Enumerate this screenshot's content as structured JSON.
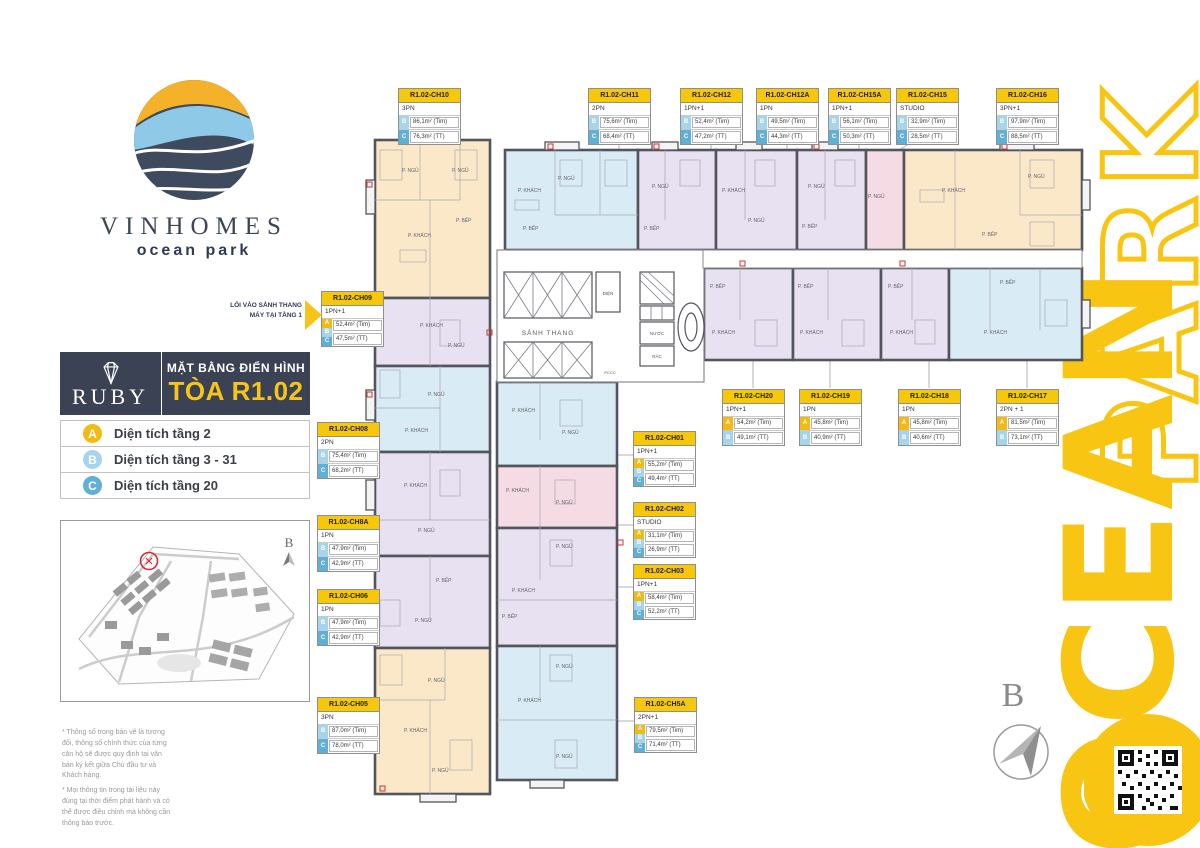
{
  "branding": {
    "logo_title": "VINHOMES",
    "logo_subtitle": "ocean park",
    "ruby_label": "RUBY",
    "plan_title_line1": "MẶT BẰNG ĐIỂN HÌNH",
    "plan_title_line2": "TÒA R1.02",
    "vertical_word1": "OCEAN",
    "vertical_word2": "PARK",
    "accent_yellow": "#F7C51A",
    "navy": "#3A4254"
  },
  "legend": {
    "items": [
      {
        "letter": "A",
        "label": "Diện tích tầng 2"
      },
      {
        "letter": "B",
        "label": "Diện tích tầng 3 - 31"
      },
      {
        "letter": "C",
        "label": "Diện tích tầng 20"
      }
    ]
  },
  "entry_note": {
    "line1": "LỐI VÀO SẢNH THANG",
    "line2": "MÁY TẠI TẦNG 1"
  },
  "compass": {
    "label": "B"
  },
  "core": {
    "lobby": "SẢNH THANG",
    "electric": "ĐIỆN",
    "water": "NƯỚC",
    "trash": "RÁC",
    "fire": "PCCC"
  },
  "rooms": {
    "bedroom": "P. NGỦ",
    "living": "P. KHÁCH",
    "kitchen": "P. BẾP",
    "dining": "P. ĂN",
    "loggia": "LÔ GIA"
  },
  "footnotes": [
    "* Thông số trong bản vẽ là tương đối, thông số chính thức của từng căn hộ sẽ được quy định tại văn bản ký kết giữa Chủ đầu tư và Khách hàng.",
    "* Mọi thông tin trong tài liệu này đúng tại thời điểm phát hành và có thể được điều chỉnh mà không cần thông báo trước."
  ],
  "units": [
    {
      "code": "R1.02-CH10",
      "type": "3PN",
      "badges": [
        "B",
        "C"
      ],
      "values": [
        "86,1m² (Tim)",
        "76,3m² (TT)"
      ],
      "x": 398,
      "y": 88
    },
    {
      "code": "R1.02-CH11",
      "type": "2PN",
      "badges": [
        "B",
        "C"
      ],
      "values": [
        "75,6m² (Tim)",
        "68,4m² (TT)"
      ],
      "x": 588,
      "y": 88
    },
    {
      "code": "R1.02-CH12",
      "type": "1PN+1",
      "badges": [
        "B",
        "C"
      ],
      "values": [
        "52,4m² (Tim)",
        "47,2m² (TT)"
      ],
      "x": 680,
      "y": 88
    },
    {
      "code": "R1.02-CH12A",
      "type": "1PN",
      "badges": [
        "B",
        "C"
      ],
      "values": [
        "49,5m² (Tim)",
        "44,3m² (TT)"
      ],
      "x": 756,
      "y": 88
    },
    {
      "code": "R1.02-CH15A",
      "type": "1PN+1",
      "badges": [
        "B",
        "C"
      ],
      "values": [
        "56,1m² (Tim)",
        "50,3m² (TT)"
      ],
      "x": 828,
      "y": 88
    },
    {
      "code": "R1.02-CH15",
      "type": "STUDIO",
      "badges": [
        "B",
        "C"
      ],
      "values": [
        "32,9m² (Tim)",
        "28,5m² (TT)"
      ],
      "x": 896,
      "y": 88
    },
    {
      "code": "R1.02-CH16",
      "type": "3PN+1",
      "badges": [
        "B",
        "C"
      ],
      "values": [
        "97,9m² (Tim)",
        "88,5m² (TT)"
      ],
      "x": 996,
      "y": 88
    },
    {
      "code": "R1.02-CH09",
      "type": "1PN+1",
      "badges": [
        "A",
        "B",
        "C"
      ],
      "values": [
        "52,4m² (Tim)",
        "47,5m² (TT)"
      ],
      "x": 321,
      "y": 291
    },
    {
      "code": "R1.02-CH08",
      "type": "2PN",
      "badges": [
        "B",
        "C"
      ],
      "values": [
        "75,4m² (Tim)",
        "68,2m² (TT)"
      ],
      "x": 317,
      "y": 422
    },
    {
      "code": "R1.02-CH8A",
      "type": "1PN",
      "badges": [
        "B",
        "C"
      ],
      "values": [
        "47,9m² (Tim)",
        "42,9m² (TT)"
      ],
      "x": 317,
      "y": 515
    },
    {
      "code": "R1.02-CH06",
      "type": "1PN",
      "badges": [
        "B",
        "C"
      ],
      "values": [
        "47,9m² (Tim)",
        "42,9m² (TT)"
      ],
      "x": 317,
      "y": 589
    },
    {
      "code": "R1.02-CH05",
      "type": "3PN",
      "badges": [
        "B",
        "C"
      ],
      "values": [
        "87,0m² (Tim)",
        "78,0m² (TT)"
      ],
      "x": 317,
      "y": 697
    },
    {
      "code": "R1.02-CH01",
      "type": "1PN+1",
      "badges": [
        "A",
        "B",
        "C"
      ],
      "values": [
        "55,2m² (Tim)",
        "49,4m² (TT)"
      ],
      "x": 633,
      "y": 431
    },
    {
      "code": "R1.02-CH02",
      "type": "STUDIO",
      "badges": [
        "A",
        "B",
        "C"
      ],
      "values": [
        "31,1m² (Tim)",
        "26,9m² (TT)"
      ],
      "x": 633,
      "y": 502
    },
    {
      "code": "R1.02-CH03",
      "type": "1PN+1",
      "badges": [
        "A",
        "B",
        "C"
      ],
      "values": [
        "58,4m² (Tim)",
        "52,2m² (TT)"
      ],
      "x": 633,
      "y": 564
    },
    {
      "code": "R1.02-CH5A",
      "type": "2PN+1",
      "badges": [
        "A",
        "B",
        "C"
      ],
      "values": [
        "79,5m² (Tim)",
        "71,4m² (TT)"
      ],
      "x": 634,
      "y": 697
    },
    {
      "code": "R1.02-CH20",
      "type": "1PN+1",
      "badges": [
        "A",
        "B"
      ],
      "values": [
        "54,2m² (Tim)",
        "49,1m² (TT)"
      ],
      "x": 722,
      "y": 389
    },
    {
      "code": "R1.02-CH19",
      "type": "1PN",
      "badges": [
        "A",
        "B"
      ],
      "values": [
        "45,8m² (Tim)",
        "40,9m² (TT)"
      ],
      "x": 799,
      "y": 389
    },
    {
      "code": "R1.02-CH18",
      "type": "1PN",
      "badges": [
        "A",
        "B"
      ],
      "values": [
        "45,8m² (Tim)",
        "40,6m² (TT)"
      ],
      "x": 898,
      "y": 389
    },
    {
      "code": "R1.02-CH17",
      "type": "2PN + 1",
      "badges": [
        "A",
        "B"
      ],
      "values": [
        "81,5m² (Tim)",
        "73,1m² (TT)"
      ],
      "x": 996,
      "y": 389
    }
  ]
}
